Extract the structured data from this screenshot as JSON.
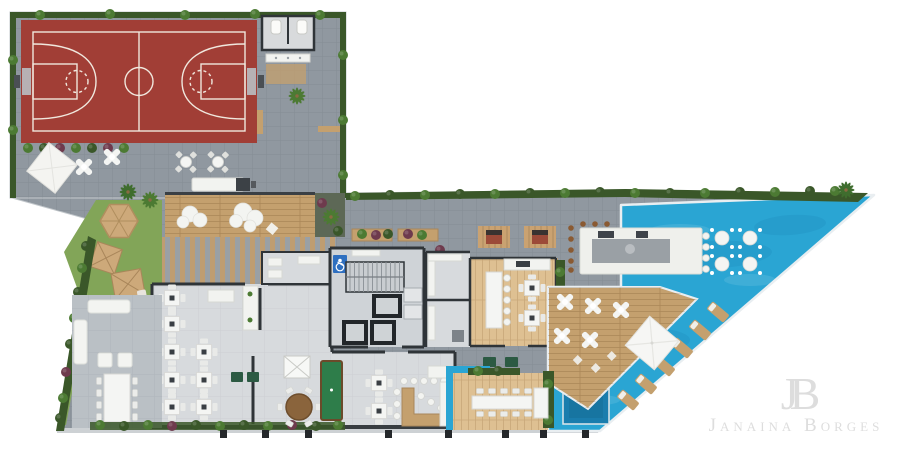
{
  "watermark": {
    "monogram": "JB",
    "name": "Janaina Borges"
  },
  "icons": {
    "accessible_parking": "♿"
  },
  "palette": {
    "canvas": "#ffffff",
    "pavement": "#9098a0",
    "pavement_light": "#bac0c5",
    "floor": "#d7dadd",
    "floor_core": "#cfd3d7",
    "court": "#a13e36",
    "court_line": "#f0e7dd",
    "lawn": "#82a558",
    "hedge": "#3a5729",
    "foliage": "#4c7a33",
    "wood": "#c4a06e",
    "wood_floor": "#dec092",
    "walk_stripe": "#bf9d71",
    "pool": "#2aa5d3",
    "pool_deep": "#1f8fc0",
    "spa": "#1a7dad",
    "white_furniture": "#f2f3f0",
    "wall": "#2f3438",
    "accent_green": "#2c5a43",
    "billiard_green": "#2e7d4a",
    "brick": "#9c4a38",
    "accessible_blue": "#2e6fc0",
    "watermark": "#dcdcdc",
    "column": "#25282b"
  }
}
